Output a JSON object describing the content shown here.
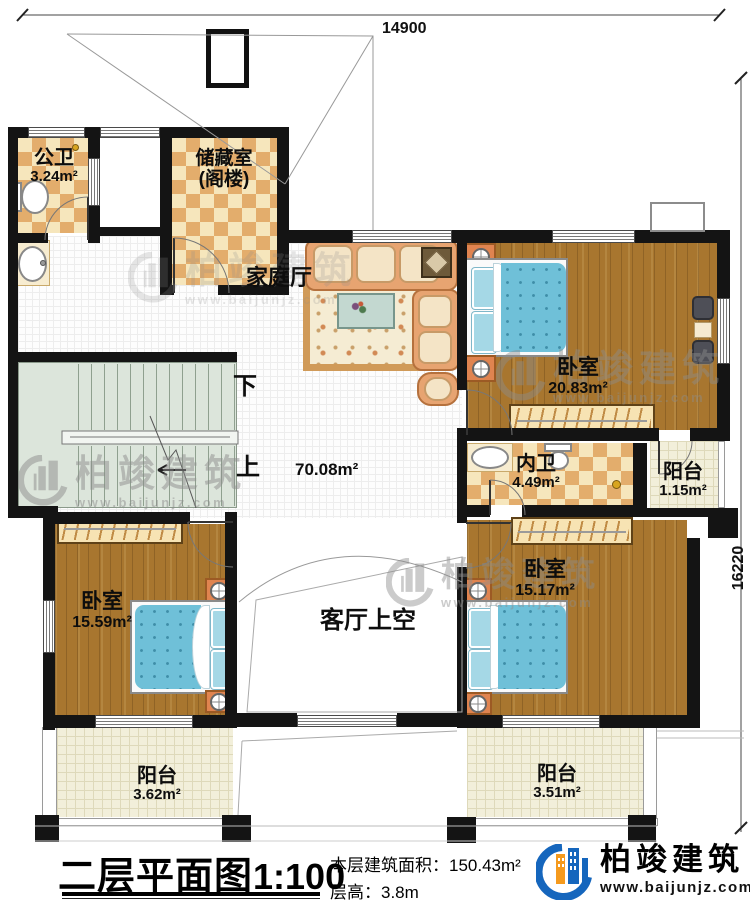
{
  "dimensions": {
    "top": "14900",
    "right": "16220"
  },
  "rooms": {
    "public_bath": {
      "name": "公卫",
      "area": "3.24m²"
    },
    "storage": {
      "name": "储藏室",
      "sub": "(阁楼)"
    },
    "family_hall": {
      "name": "家庭厅",
      "area": "70.08m²"
    },
    "bedroom_top_right": {
      "name": "卧室",
      "area": "20.83m²"
    },
    "ensuite_bath": {
      "name": "内卫",
      "area": "4.49m²"
    },
    "balcony_right": {
      "name": "阳台",
      "area": "1.15m²"
    },
    "bedroom_bottom_left": {
      "name": "卧室",
      "area": "15.59m²"
    },
    "bedroom_bottom_right": {
      "name": "卧室",
      "area": "15.17m²"
    },
    "living_void": {
      "name": "客厅上空"
    },
    "balcony_bottom_left": {
      "name": "阳台",
      "area": "3.62m²"
    },
    "balcony_bottom_right": {
      "name": "阳台",
      "area": "3.51m²"
    }
  },
  "stairs": {
    "down": "下",
    "up": "上"
  },
  "titleblock": {
    "title": "二层平面图",
    "scale": "1:100",
    "area_label": "本层建筑面积：",
    "area_value": "150.43m²",
    "height_label": "层高：",
    "height_value": "3.8m"
  },
  "brand": {
    "name": "柏竣建筑",
    "url": "www.baijunjz.com"
  },
  "watermark": {
    "name": "柏竣建筑",
    "url": "www.baijunjz.com"
  },
  "colors": {
    "wall": "#141414",
    "wood_floor": "#a8762f",
    "tile_dark": "#e3ad6c",
    "tile_light": "#f6e6bc",
    "bed_blue": "#6fc0d8",
    "stairs_green": "#dce5db",
    "balcony_cream": "#f2efda",
    "brand_blue": "#1566bd",
    "brand_orange": "#f59a1d"
  }
}
